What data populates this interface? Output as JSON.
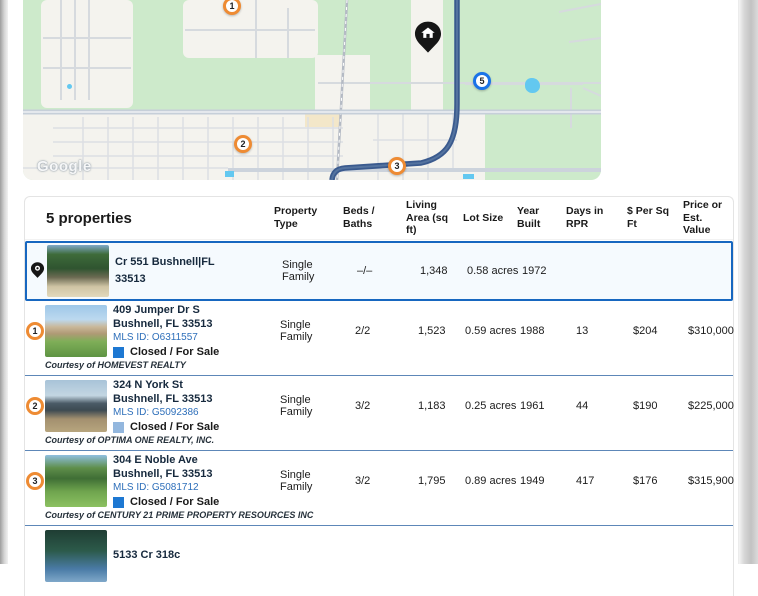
{
  "colors": {
    "accent_blue": "#1767c0",
    "marker_orange": "#ee8b33",
    "marker_blue": "#1a73e8",
    "status_closed_blue": "#1e78d2",
    "status_closed_light": "#93b7de",
    "row_separator": "#5d87b8",
    "route_navy": "#3a5a8e",
    "map_green": "#cdeacb"
  },
  "map": {
    "watermark": "Google",
    "legend": {
      "label": "Closed",
      "color": "#f09137"
    },
    "markers": [
      {
        "n": "1",
        "color": "#ee8b33"
      },
      {
        "n": "2",
        "color": "#ee8b33"
      },
      {
        "n": "3",
        "color": "#ee8b33"
      },
      {
        "n": "5",
        "color": "#1a73e8"
      }
    ],
    "subject_pin": "home-pin"
  },
  "table": {
    "title": "5 properties",
    "columns": [
      "Property Type",
      "Beds / Baths",
      "Living Area (sq ft)",
      "Lot Size",
      "Year Built",
      "Days in RPR",
      "$ Per Sq Ft",
      "Price or Est. Value"
    ],
    "rows": [
      {
        "marker": "pin",
        "address_line1": "Cr 551 Bushnell|FL",
        "address_line2": "33513",
        "mls": "",
        "status": "",
        "status_color": "",
        "property_type": "Single Family",
        "beds_baths": "–/–",
        "living_area": "1,348",
        "lot_size": "0.58 acres",
        "year_built": "1972",
        "days_in_rpr": "",
        "per_sq_ft": "",
        "price": "",
        "courtesy": ""
      },
      {
        "marker": "1",
        "address_line1": "409 Jumper Dr S",
        "address_line2": "Bushnell, FL 33513",
        "mls": "MLS ID: O6311557",
        "status": "Closed / For Sale",
        "status_color": "#1e78d2",
        "property_type": "Single Family",
        "beds_baths": "2/2",
        "living_area": "1,523",
        "lot_size": "0.59 acres",
        "year_built": "1988",
        "days_in_rpr": "13",
        "per_sq_ft": "$204",
        "price": "$310,000",
        "courtesy": "Courtesy of HOMEVEST REALTY"
      },
      {
        "marker": "2",
        "address_line1": "324 N York St",
        "address_line2": "Bushnell, FL 33513",
        "mls": "MLS ID: G5092386",
        "status": "Closed / For Sale",
        "status_color": "#93b7de",
        "property_type": "Single Family",
        "beds_baths": "3/2",
        "living_area": "1,183",
        "lot_size": "0.25 acres",
        "year_built": "1961",
        "days_in_rpr": "44",
        "per_sq_ft": "$190",
        "price": "$225,000",
        "courtesy": "Courtesy of OPTIMA ONE REALTY, INC."
      },
      {
        "marker": "3",
        "address_line1": "304 E Noble Ave",
        "address_line2": "Bushnell, FL 33513",
        "mls": "MLS ID: G5081712",
        "status": "Closed / For Sale",
        "status_color": "#1e78d2",
        "property_type": "Single Family",
        "beds_baths": "3/2",
        "living_area": "1,795",
        "lot_size": "0.89 acres",
        "year_built": "1949",
        "days_in_rpr": "417",
        "per_sq_ft": "$176",
        "price": "$315,900",
        "courtesy": "Courtesy of CENTURY 21 PRIME PROPERTY RESOURCES INC"
      },
      {
        "marker": "",
        "address_line1": "5133 Cr 318c",
        "address_line2": "",
        "mls": "",
        "status": "",
        "status_color": "",
        "property_type": "",
        "beds_baths": "",
        "living_area": "",
        "lot_size": "",
        "year_built": "",
        "days_in_rpr": "",
        "per_sq_ft": "",
        "price": "",
        "courtesy": ""
      }
    ]
  }
}
